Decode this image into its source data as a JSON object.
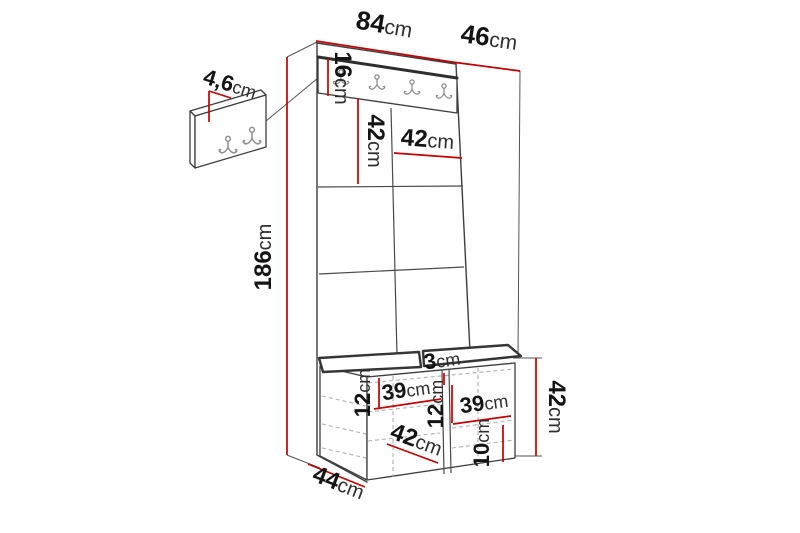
{
  "diagram": {
    "subject": "hallway-furniture-dimension-diagram",
    "unit_system": "cm",
    "colors": {
      "dimension_line": "#c40000",
      "outline": "#3d3d3d",
      "hidden_edge": "#b1b1b1",
      "label_text": "#141414",
      "background": "#ffffff"
    },
    "dims": {
      "top_width": {
        "num": "84",
        "unit": "cm"
      },
      "top_depth": {
        "num": "46",
        "unit": "cm"
      },
      "total_height": {
        "num": "186",
        "unit": "cm"
      },
      "rail_height": {
        "num": "16",
        "unit": "cm"
      },
      "panel_tile_height": {
        "num": "42",
        "unit": "cm"
      },
      "panel_tile_width": {
        "num": "42",
        "unit": "cm"
      },
      "wall_panel_thickness": {
        "num": "4,6",
        "unit": "cm"
      },
      "bench_shelf_offset_left": {
        "num": "12",
        "unit": "cm"
      },
      "bench_shelf_width_left": {
        "num": "39",
        "unit": "cm"
      },
      "bench_divider_thickness": {
        "num": "3",
        "unit": "cm"
      },
      "bench_shelf_offset_center": {
        "num": "12",
        "unit": "cm"
      },
      "bench_shelf_width_right": {
        "num": "39",
        "unit": "cm"
      },
      "bench_bottom_clearance": {
        "num": "10",
        "unit": "cm"
      },
      "bench_height": {
        "num": "42",
        "unit": "cm"
      },
      "bench_inner_width": {
        "num": "42",
        "unit": "cm"
      },
      "bench_depth": {
        "num": "44",
        "unit": "cm"
      }
    }
  }
}
